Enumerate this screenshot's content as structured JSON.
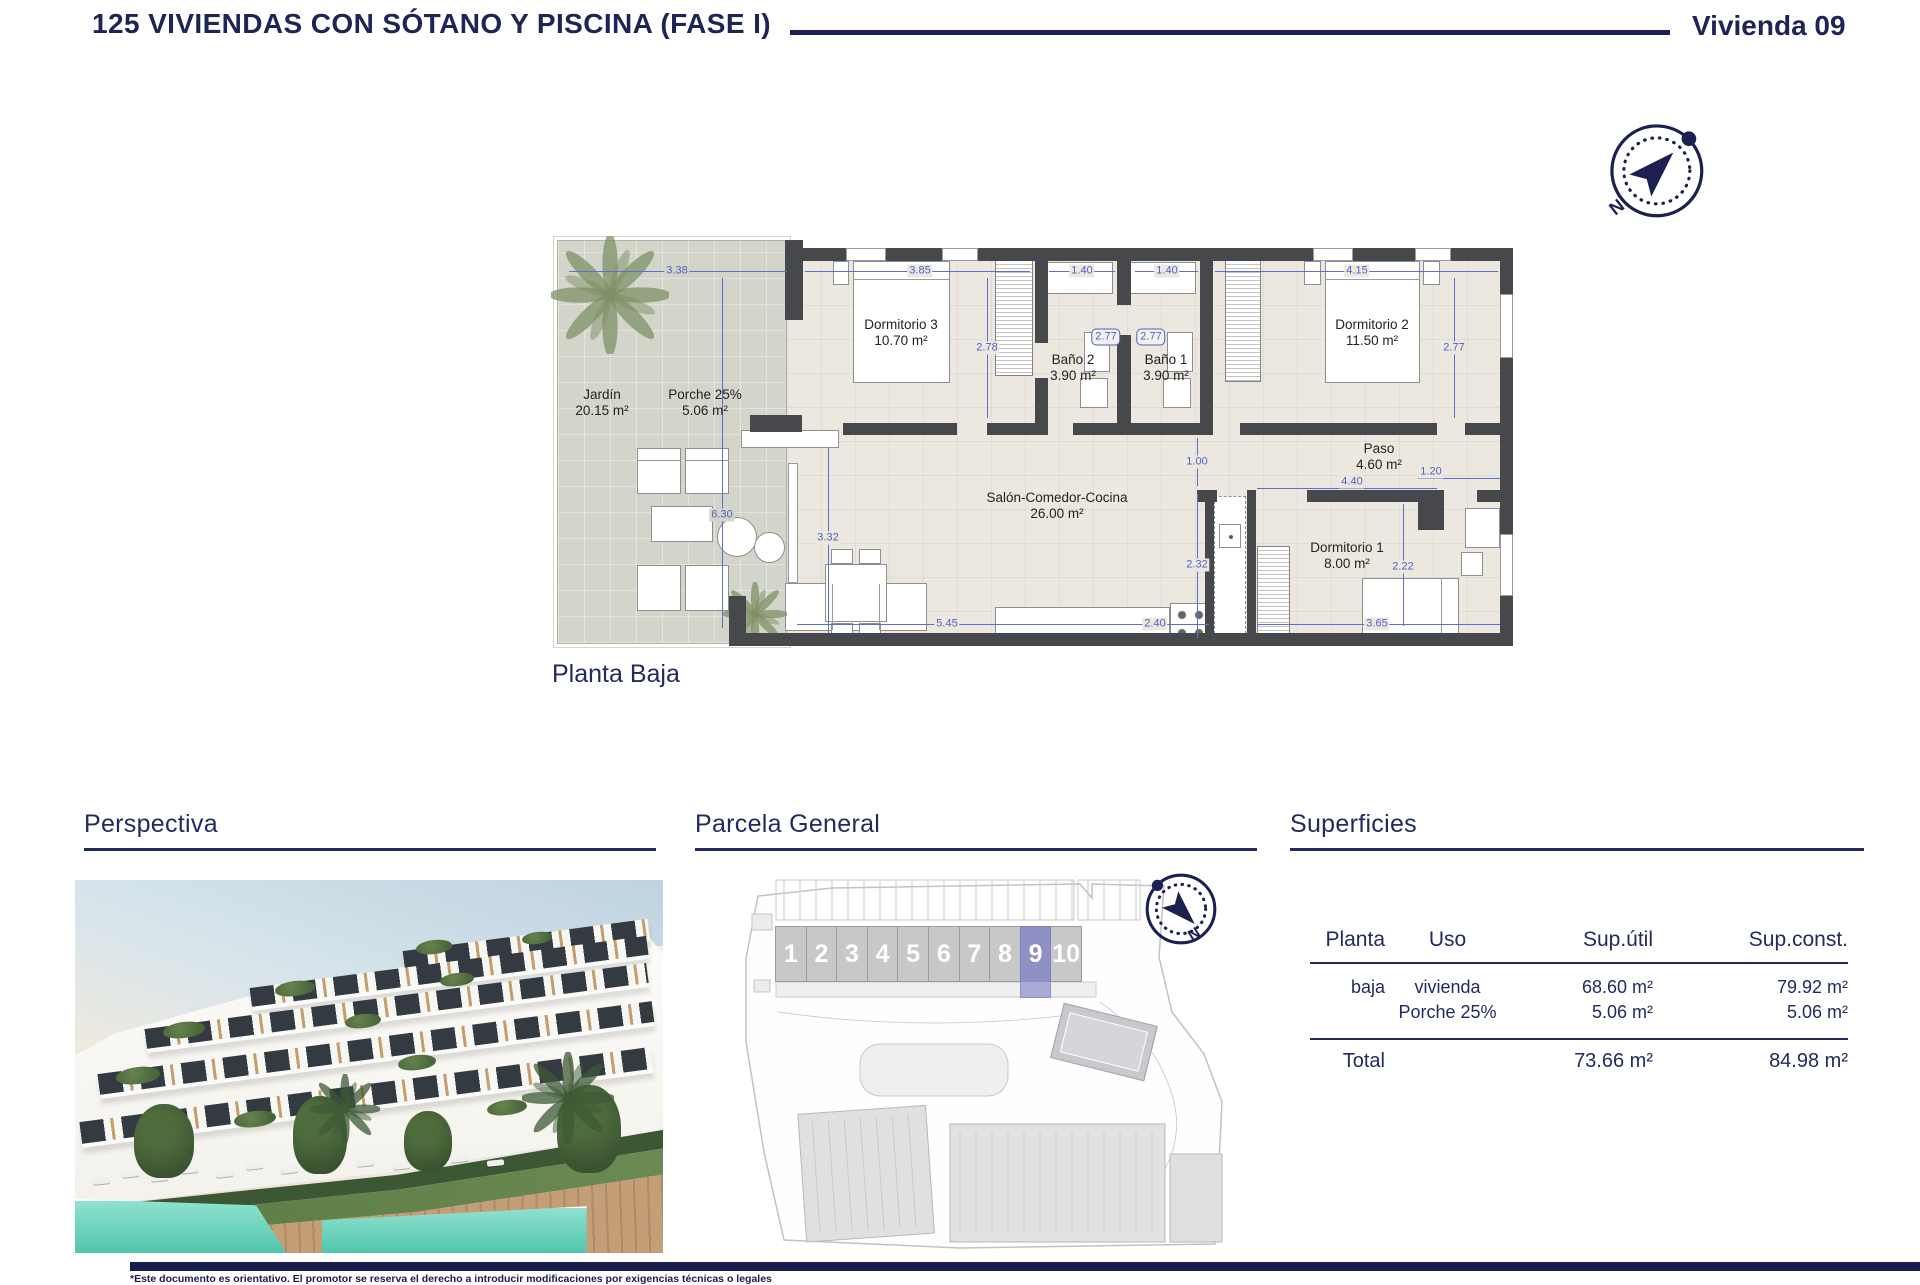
{
  "header": {
    "title": "125 VIVIENDAS CON SÓTANO Y PISCINA (FASE I)",
    "unit_label": "Vivienda 09"
  },
  "plan": {
    "caption": "Planta Baja",
    "compass_north": "N",
    "rooms": [
      {
        "name": "Jardín",
        "area": "20.15 m²"
      },
      {
        "name": "Porche 25%",
        "area": "5.06 m²"
      },
      {
        "name": "Dormitorio 3",
        "area": "10.70 m²"
      },
      {
        "name": "Baño 2",
        "area": "3.90 m²"
      },
      {
        "name": "Baño 1",
        "area": "3.90 m²"
      },
      {
        "name": "Dormitorio 2",
        "area": "11.50 m²"
      },
      {
        "name": "Salón-Comedor-Cocina",
        "area": "26.00 m²"
      },
      {
        "name": "Paso",
        "area": "4.60 m²"
      },
      {
        "name": "Dormitorio 1",
        "area": "8.00 m²"
      }
    ],
    "dims": [
      "3.38",
      "3.85",
      "1.40",
      "1.40",
      "4.15",
      "2.78",
      "2.77",
      "2.77",
      "2.77",
      "6.30",
      "3.32",
      "1.00",
      "4.40",
      "1.20",
      "2.32",
      "2.22",
      "5.45",
      "2.40",
      "3.65"
    ]
  },
  "sections": {
    "perspectiva": {
      "title": "Perspectiva"
    },
    "parcela": {
      "title": "Parcela General",
      "units": [
        "1",
        "2",
        "3",
        "4",
        "5",
        "6",
        "7",
        "8",
        "9",
        "10"
      ],
      "highlighted_unit": "9",
      "compass_north": "N"
    },
    "superficies": {
      "title": "Superficies",
      "columns": [
        "Planta",
        "Uso",
        "Sup.útil",
        "Sup.const."
      ],
      "rows": [
        {
          "planta": "baja",
          "uso": "vivienda",
          "sup_util": "68.60 m²",
          "sup_const": "79.92 m²"
        },
        {
          "planta": "",
          "uso": "Porche 25%",
          "sup_util": "5.06 m²",
          "sup_const": "5.06 m²"
        }
      ],
      "total": {
        "label": "Total",
        "sup_util": "73.66 m²",
        "sup_const": "84.98 m²"
      }
    }
  },
  "footer": {
    "disclaimer": "*Este documento es orientativo. El promotor se reserva el derecho a introducir modificaciones por exigencias técnicas o legales"
  },
  "colors": {
    "navy": "#1b2050",
    "dimension_blue": "#4f61c6",
    "wall_gray": "#46484c",
    "floor_beige": "#ece8e0",
    "garden_gray": "#d4d5ca",
    "unit_highlight": "#8f91c6",
    "pool_teal": "#6fd7c0"
  }
}
